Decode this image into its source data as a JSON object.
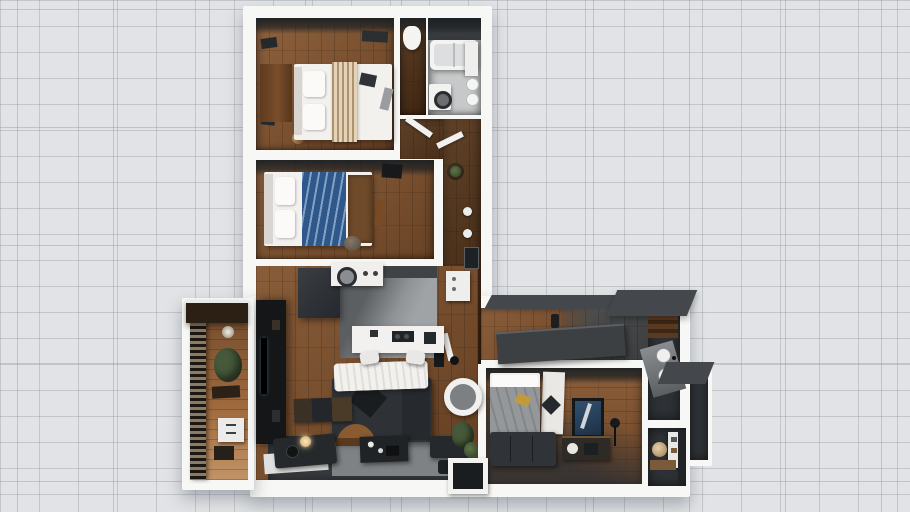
{
  "scene": {
    "type": "3d-floor-plan",
    "description": "Top-down 3D render of an L-shaped apartment floor plan on a light blueprint tile grid",
    "background": {
      "base": "#e1e3e6",
      "grid_line": "#c6c9ce"
    },
    "palette": {
      "wall": "#f7f7f5",
      "wood_mid": "#7c4e2a",
      "wood_red": "#82532e",
      "wood_dark": "#4e2f16",
      "wood_light": "#a06a3e",
      "tile_light": "#c6c8c9",
      "concrete": "#a0a3a5",
      "charcoal": "#2e3236",
      "near_black": "#141618",
      "roof_gray": "#44484c",
      "linen_white": "#f2f1ee",
      "throw_beige": "#c9b190",
      "duvet_blue": "#3d6da3",
      "duvet_gray": "#94989b",
      "rug_gray": "#7e8285",
      "rug_dark": "#383c3f",
      "plant_green": "#46593a",
      "balcony_awning": "#2c2014"
    }
  },
  "rooms": [
    {
      "id": "bedroom-1",
      "label": "bedroom-top-left",
      "furniture": [
        "double-bed",
        "beige-throw",
        "pillows",
        "wardrobe",
        "baskets",
        "wall-art",
        "ceiling-vent"
      ]
    },
    {
      "id": "wc",
      "label": "small-wc",
      "furniture": [
        "toilet"
      ]
    },
    {
      "id": "bathroom",
      "label": "bathroom-top-right",
      "furniture": [
        "bathtub",
        "washing-machine",
        "sink-bowls",
        "cabinet"
      ]
    },
    {
      "id": "bedroom-2",
      "label": "bedroom-middle",
      "furniture": [
        "double-bed",
        "blue-duvet",
        "foot-bench",
        "tv",
        "pouf",
        "wall-shelf"
      ]
    },
    {
      "id": "hallway",
      "label": "hallway-l-shape",
      "furniture": [
        "plant-table",
        "wall-lights",
        "picture-frame",
        "white-cabinet",
        "open-door-leaves"
      ]
    },
    {
      "id": "kitchen",
      "label": "kitchen",
      "furniture": [
        "island-counter",
        "cooktop",
        "bar-stools",
        "white-appliance",
        "dark-counter"
      ]
    },
    {
      "id": "living-room",
      "label": "living-room",
      "furniture": [
        "corner-sofa",
        "white-throw",
        "coffee-table",
        "two-tone-rug",
        "media-wall",
        "chaise-daybed",
        "floor-lamp",
        "leaning-frames",
        "plants",
        "doormat",
        "ottomans",
        "tall-cabinet"
      ]
    },
    {
      "id": "entry-corridor",
      "label": "entry-corridor",
      "furniture": [
        "long-sideboard",
        "decor-bottle"
      ]
    },
    {
      "id": "bedroom-3",
      "label": "bedroom-right",
      "furniture": [
        "double-bed",
        "gray-duvet",
        "runner-rug",
        "blue-artwork",
        "sofa",
        "console",
        "desk-lamp"
      ]
    },
    {
      "id": "ensuite",
      "label": "ensuite-bath",
      "furniture": [
        "twin-round-sinks",
        "angled-counter",
        "wood-shelf"
      ]
    },
    {
      "id": "powder-room",
      "label": "powder-room",
      "furniture": [
        "round-mirror",
        "vanity-shelf",
        "white-shelf-unit",
        "dark-door"
      ]
    },
    {
      "id": "balcony",
      "label": "balcony",
      "furniture": [
        "railing",
        "awning",
        "plant",
        "drawer-unit",
        "bench",
        "wall-light"
      ]
    }
  ]
}
